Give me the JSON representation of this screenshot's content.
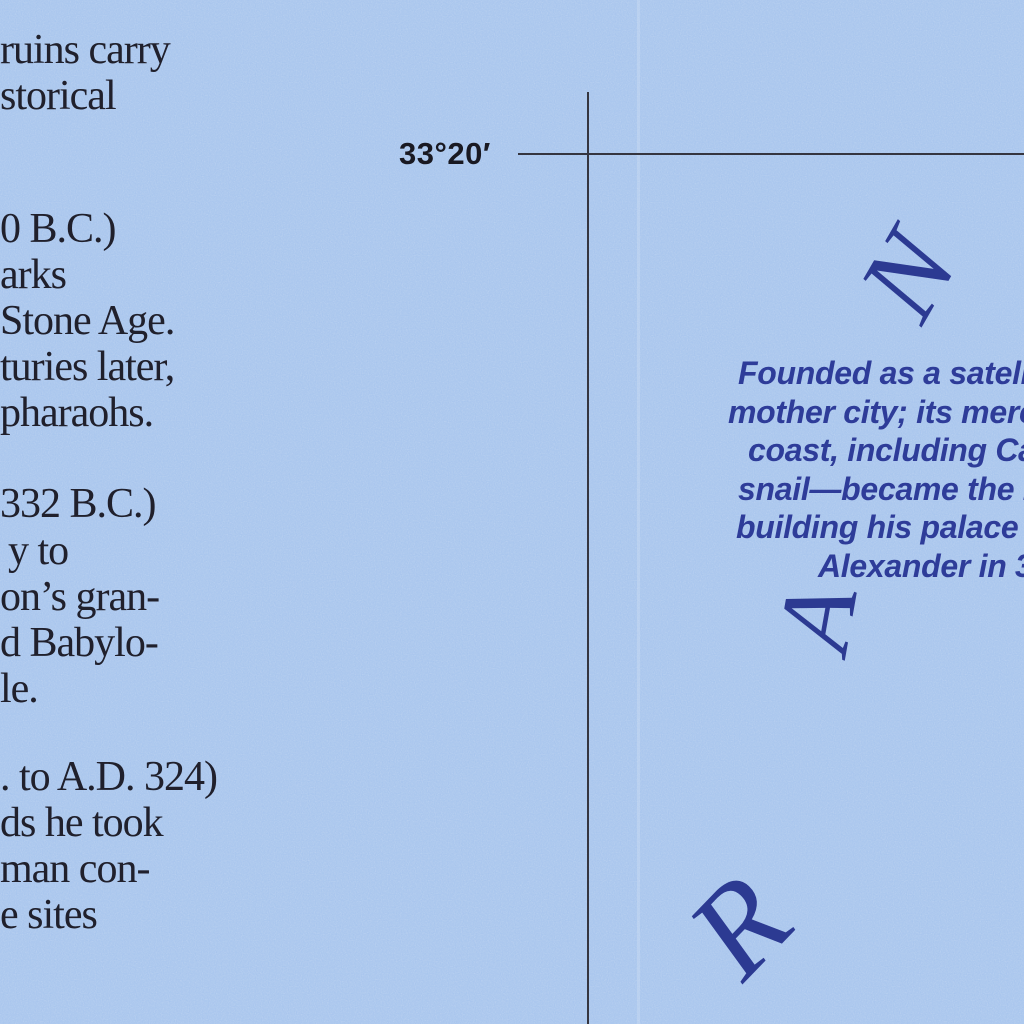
{
  "colors": {
    "sea_blue": "#a6c4ed",
    "ink_black": "#20202c",
    "ink_navy": "#2e3c99",
    "graticule_line": "#35353f"
  },
  "graticule": {
    "latitude_label": "33°20′"
  },
  "left_note": {
    "lines": [
      "ruins carry",
      "storical",
      "0 B.C.)",
      "arks",
      "Stone Age.",
      "turies later,",
      "pharaohs.",
      "332 B.C.)",
      "y to",
      "on’s gran-",
      "d Babylo-",
      "le.",
      ". to A.D. 324)",
      "ds he took",
      "man con-",
      "e sites"
    ]
  },
  "sea_annotation": {
    "lines": [
      "Founded as a satellit",
      "mother city; its merc",
      "coast, including Ca",
      "snail—became the m",
      "building his palace a",
      "Alexander in 3"
    ]
  },
  "sea_name_letters": {
    "letters": [
      "N",
      "A",
      "R"
    ]
  }
}
